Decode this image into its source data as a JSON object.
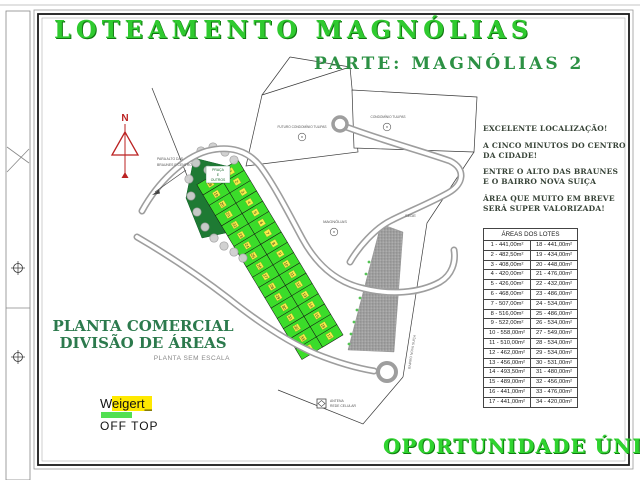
{
  "title": "LOTEAMENTO MAGNÓLIAS",
  "subtitle": "PARTE: MAGNÓLIAS 2",
  "promo": {
    "l1": "EXCELENTE LOCALIZAÇÃO!",
    "l2": "A CINCO MINUTOS DO CENTRO",
    "l3": "DA CIDADE!",
    "l4": "ENTRE O ALTO DAS BRAUNES",
    "l5": "E O BAIRRO NOVA SUIÇA",
    "l6": "ÁREA QUE MUITO EM BREVE",
    "l7": "SERÁ SUPER VALORIZADA!"
  },
  "lot_table": {
    "title": "ÁREAS DOS LOTES",
    "left_column": [
      "1 - 441,00m²",
      "2 - 482,50m²",
      "3 - 408,00m²",
      "4 - 420,00m²",
      "5 - 426,00m²",
      "6 - 468,00m²",
      "7 - 507,00m²",
      "8 - 516,00m²",
      "9 - 522,00m²",
      "10 - 558,00m²",
      "11 - 510,00m²",
      "12 - 462,00m²",
      "13 - 456,00m²",
      "14 - 493,50m²",
      "15 - 489,00m²",
      "16 - 441,00m²",
      "17 - 441,00m²"
    ],
    "right_column": [
      "18 - 441,00m²",
      "19 - 434,00m²",
      "20 - 448,00m²",
      "21 - 476,00m²",
      "22 - 432,00m²",
      "23 - 486,00m²",
      "24 - 534,00m²",
      "25 - 486,00m²",
      "26 - 534,00m²",
      "27 - 549,00m²",
      "28 - 534,00m²",
      "29 - 534,00m²",
      "30 - 531,00m²",
      "31 - 480,00m²",
      "32 - 456,00m²",
      "33 - 476,00m²",
      "34 - 420,00m²"
    ]
  },
  "map": {
    "north": "N",
    "direction_l1": "PARA ALTO DAS",
    "direction_l2": "BRAUNES E CENTRO",
    "future_condo": "FUTURO CONDOMÍNIO TULIPAS",
    "condo": "CONDOMÍNIO TULIPAS",
    "magnolias": "MAGNÓLIAS",
    "sede": "SEDE",
    "praca_l1": "PRAÇA",
    "praca_l2": "E",
    "praca_l3": "OUTROS",
    "bairro": "BAIRRO NOVA SUIÇA",
    "antenna_l1": "ANTENA",
    "antenna_l2": "REDE CELULAR",
    "lot_numbers": [
      1,
      2,
      3,
      4,
      5,
      6,
      7,
      8,
      9,
      10,
      11,
      12,
      13,
      14,
      15,
      16,
      17,
      18,
      19,
      20,
      21,
      22,
      23,
      24,
      25,
      26,
      27,
      28,
      29,
      30,
      31,
      32,
      33,
      34
    ]
  },
  "plan": {
    "line1": "PLANTA COMERCIAL",
    "line2": "DIVISÃO DE ÁREAS",
    "note": "PLANTA SEM ESCALA"
  },
  "logo": {
    "name_first": "W",
    "name_rest": "eigert_",
    "sub": "OFF TOP"
  },
  "opportunity": "OPORTUNIDADE ÚNICA!!",
  "colors": {
    "title_green": "#2fca2f",
    "dark_green": "#2c7a4d",
    "lot_green": "#3bdc2a",
    "praca_green": "#1e7a33",
    "compass_red": "#bb2222"
  }
}
